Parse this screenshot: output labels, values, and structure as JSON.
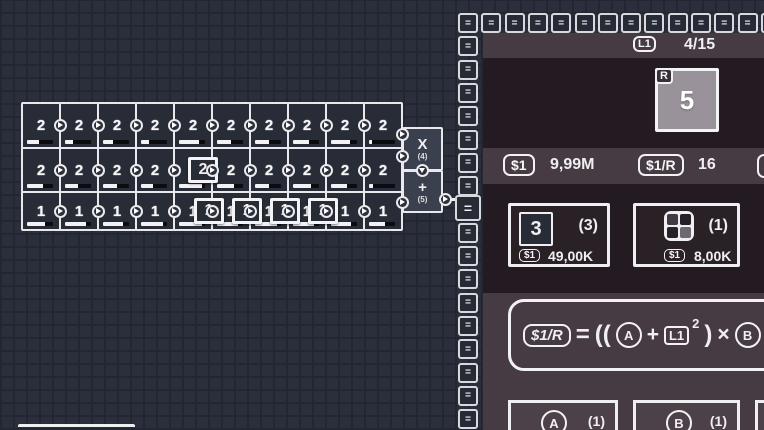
{
  "colors": {
    "background": "#2b2f3b",
    "panel_dark": "#241a21",
    "panel_purple": "#473b43",
    "cell_fill": "#272c36",
    "tile_gray": "#99929b",
    "line_white": "#efeef0"
  },
  "grid": {
    "rows": [
      {
        "values": [
          "2",
          "2",
          "2",
          "2",
          "2",
          "2",
          "2",
          "2",
          "2",
          "2"
        ],
        "progress": [
          45,
          30,
          38,
          30,
          78,
          52,
          55,
          60,
          72,
          10
        ]
      },
      {
        "values": [
          "2",
          "2",
          "2",
          "2",
          "2",
          "2",
          "2",
          "2",
          "2",
          "2"
        ],
        "progress": [
          60,
          50,
          55,
          45,
          88,
          65,
          52,
          70,
          60,
          15
        ]
      },
      {
        "values": [
          "1",
          "1",
          "1",
          "1",
          "1",
          "1",
          "1",
          "1",
          "1",
          "1"
        ],
        "progress": [
          70,
          80,
          75,
          85,
          90,
          82,
          85,
          80,
          75,
          60
        ]
      }
    ],
    "belt_items": [
      {
        "row": 1,
        "cx": 203,
        "label": "2"
      },
      {
        "row": 2,
        "cx": 209,
        "label": "1"
      },
      {
        "row": 2,
        "cx": 247,
        "label": "1"
      },
      {
        "row": 2,
        "cx": 285,
        "label": "1"
      },
      {
        "row": 2,
        "cx": 323,
        "label": "1"
      }
    ]
  },
  "machines": {
    "multiply": {
      "label": "X",
      "count": "(4)"
    },
    "add": {
      "label": "+",
      "count": "(5)"
    }
  },
  "conveyor": {
    "glyph": "=",
    "top_count": 14,
    "left_count": 18,
    "highlight_index": 8
  },
  "panel": {
    "header": {
      "level_badge": "L1",
      "progress": "4/15"
    },
    "reward_tile": {
      "badge": "R",
      "value": "5"
    },
    "stats": {
      "money_badge": "$1",
      "money_value": "9,99M",
      "rate_badge": "$1/R",
      "rate_value": "16"
    },
    "shop_cards": [
      {
        "tile_value": "3",
        "count": "(3)",
        "cost_badge": "$1",
        "cost": "49,00K"
      },
      {
        "icon": "board-grid-icon",
        "count": "(1)",
        "cost_badge": "$1",
        "cost": "8,00K"
      }
    ],
    "formula": {
      "result_badge": "$1/R",
      "tokens": [
        {
          "t": "text",
          "v": "="
        },
        {
          "t": "text",
          "v": "(("
        },
        {
          "t": "circle",
          "v": "A"
        },
        {
          "t": "op",
          "v": "+"
        },
        {
          "t": "box",
          "v": "L1"
        },
        {
          "t": "sup",
          "v": "2"
        },
        {
          "t": "text",
          "v": ")"
        },
        {
          "t": "op",
          "v": "×"
        },
        {
          "t": "circle",
          "v": "B"
        },
        {
          "t": "text",
          "v": ")"
        }
      ]
    },
    "bottom_cards": [
      {
        "symbol": "A",
        "count": "(1)"
      },
      {
        "symbol": "B",
        "count": "(1)"
      }
    ]
  }
}
